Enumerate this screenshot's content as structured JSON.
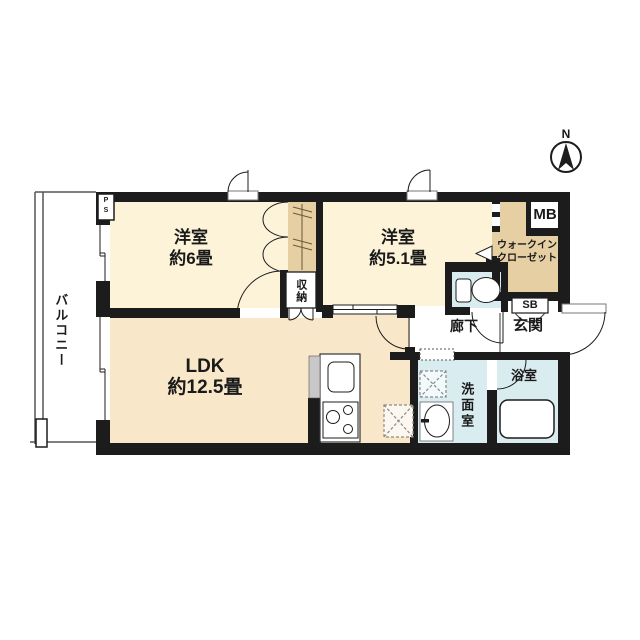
{
  "plan": {
    "compass_north": "N",
    "rooms": {
      "balcony": {
        "label": "バルコニー"
      },
      "bedroom1": {
        "name": "洋室",
        "size": "約6畳"
      },
      "bedroom2": {
        "name": "洋室",
        "size": "約5.1畳"
      },
      "ldk": {
        "name": "LDK",
        "size": "約12.5畳"
      },
      "closet": {
        "label": "収納"
      },
      "walk_in_closet": {
        "line1": "ウォークイン",
        "line2": "クローゼット"
      },
      "hallway": {
        "label": "廊下"
      },
      "entrance": {
        "label": "玄関"
      },
      "washroom": {
        "label": "洗面室"
      },
      "bathroom": {
        "label": "浴室"
      }
    },
    "labels": {
      "mb": "MB",
      "sb": "SB",
      "ps_p": "P",
      "ps_s": "S"
    },
    "colors": {
      "wall": "#1c1c1c",
      "bedroom_floor": "#fcf3d8",
      "ldk_floor": "#f8e7c9",
      "closet_floor": "#e5cfa3",
      "wet_area_floor": "#d9ecf0",
      "counter_gray": "#c8c8c8"
    }
  }
}
